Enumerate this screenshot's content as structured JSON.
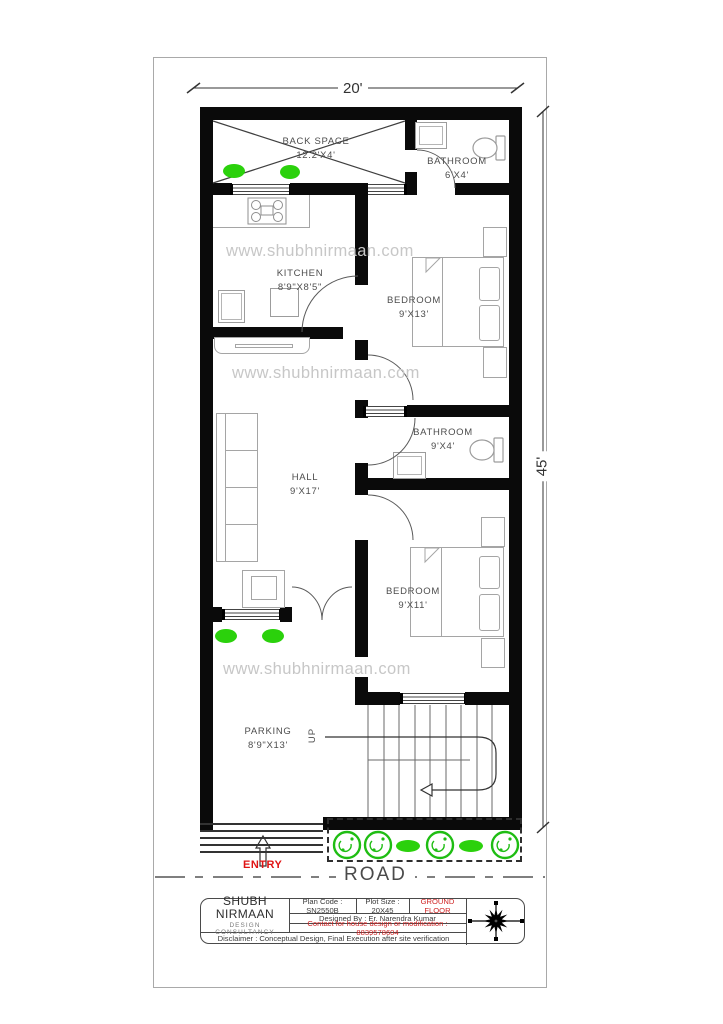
{
  "drawing": {
    "width_dim": "20'",
    "height_dim": "45'",
    "watermark": "www.shubhnirmaan.com",
    "road": "ROAD",
    "entry": "ENTRY",
    "up": "UP"
  },
  "rooms": {
    "back_space": {
      "name": "BACK SPACE",
      "size": "12.2'X4'"
    },
    "bathroom_top": {
      "name": "BATHROOM",
      "size": "6'X4'"
    },
    "kitchen": {
      "name": "KITCHEN",
      "size": "8'9\"X8'5\""
    },
    "bedroom_top": {
      "name": "BEDROOM",
      "size": "9'X13'"
    },
    "bathroom_mid": {
      "name": "BATHROOM",
      "size": "9'X4'"
    },
    "hall": {
      "name": "HALL",
      "size": "9'X17'"
    },
    "bedroom_bottom": {
      "name": "BEDROOM",
      "size": "9'X11'"
    },
    "parking": {
      "name": "PARKING",
      "size": "8'9\"X13'"
    }
  },
  "title_block": {
    "company": "SHUBH NIRMAAN",
    "subtitle": "DESIGN CONSULTANCY",
    "plan_code": "Plan Code : SN2550B",
    "plot_size": "Plot Size : 20X45",
    "floor": "GROUND FLOOR",
    "designed_by": "Designed By : Er. Narendra Kumar",
    "contact": "Contact for house design or modification : 8839578604",
    "disclaimer": "Disclaimer : Conceptual Design, Final Execution after site verification"
  },
  "colors": {
    "wall": "#0a0a0a",
    "accent_red": "#cf2424",
    "plant_green": "#2bd10c",
    "watermark_gray": "#c7c7c7"
  }
}
